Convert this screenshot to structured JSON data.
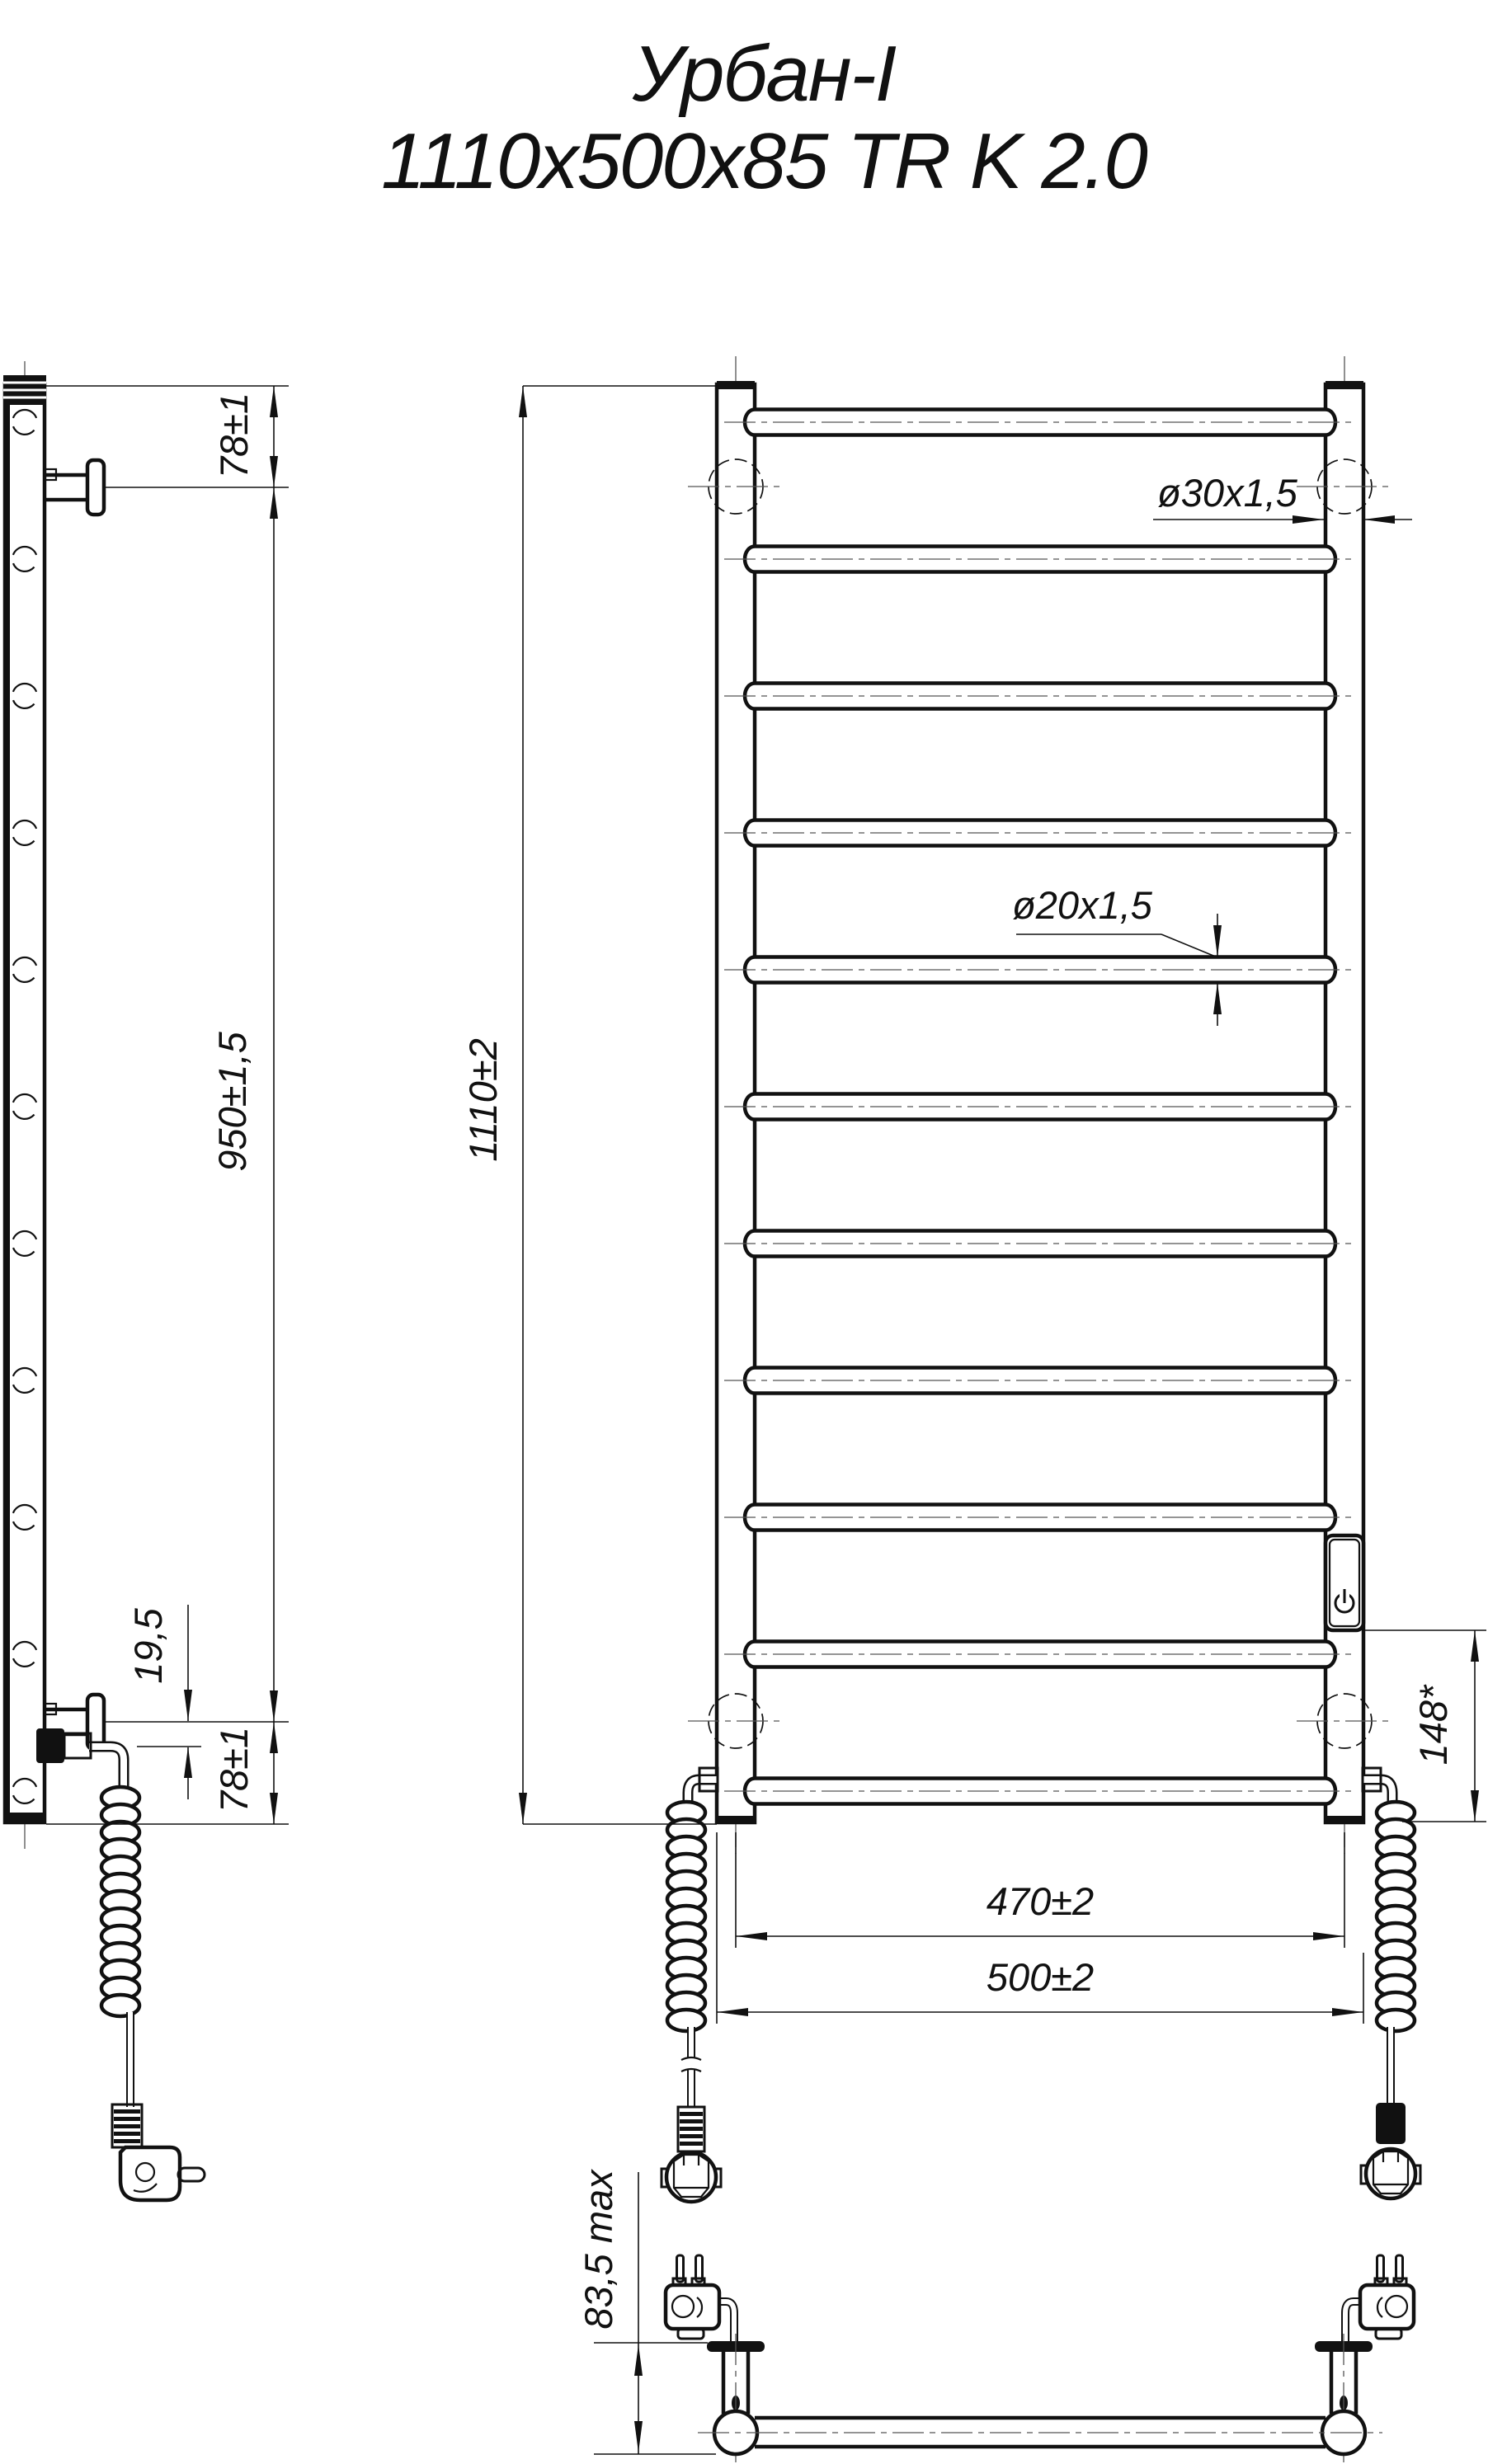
{
  "title": {
    "line1": "Урбан-I",
    "line2": "1110x500x85 TR K 2.0"
  },
  "dims": {
    "side_top_offset": "78±1",
    "side_bracket_span": "950±1,5",
    "side_cable_offset": "19,5",
    "side_bottom_offset": "78±1",
    "front_height": "1110±2",
    "rail_tube": "ø30x1,5",
    "rung_tube": "ø20x1,5",
    "switch_to_bottom": "148*",
    "bracket_centers_width": "470±2",
    "overall_width": "500±2",
    "depth_max": "83,5 max"
  },
  "icons": {
    "power_switch": "power-icon"
  },
  "colors": {
    "line": "#111111",
    "background": "#ffffff"
  }
}
